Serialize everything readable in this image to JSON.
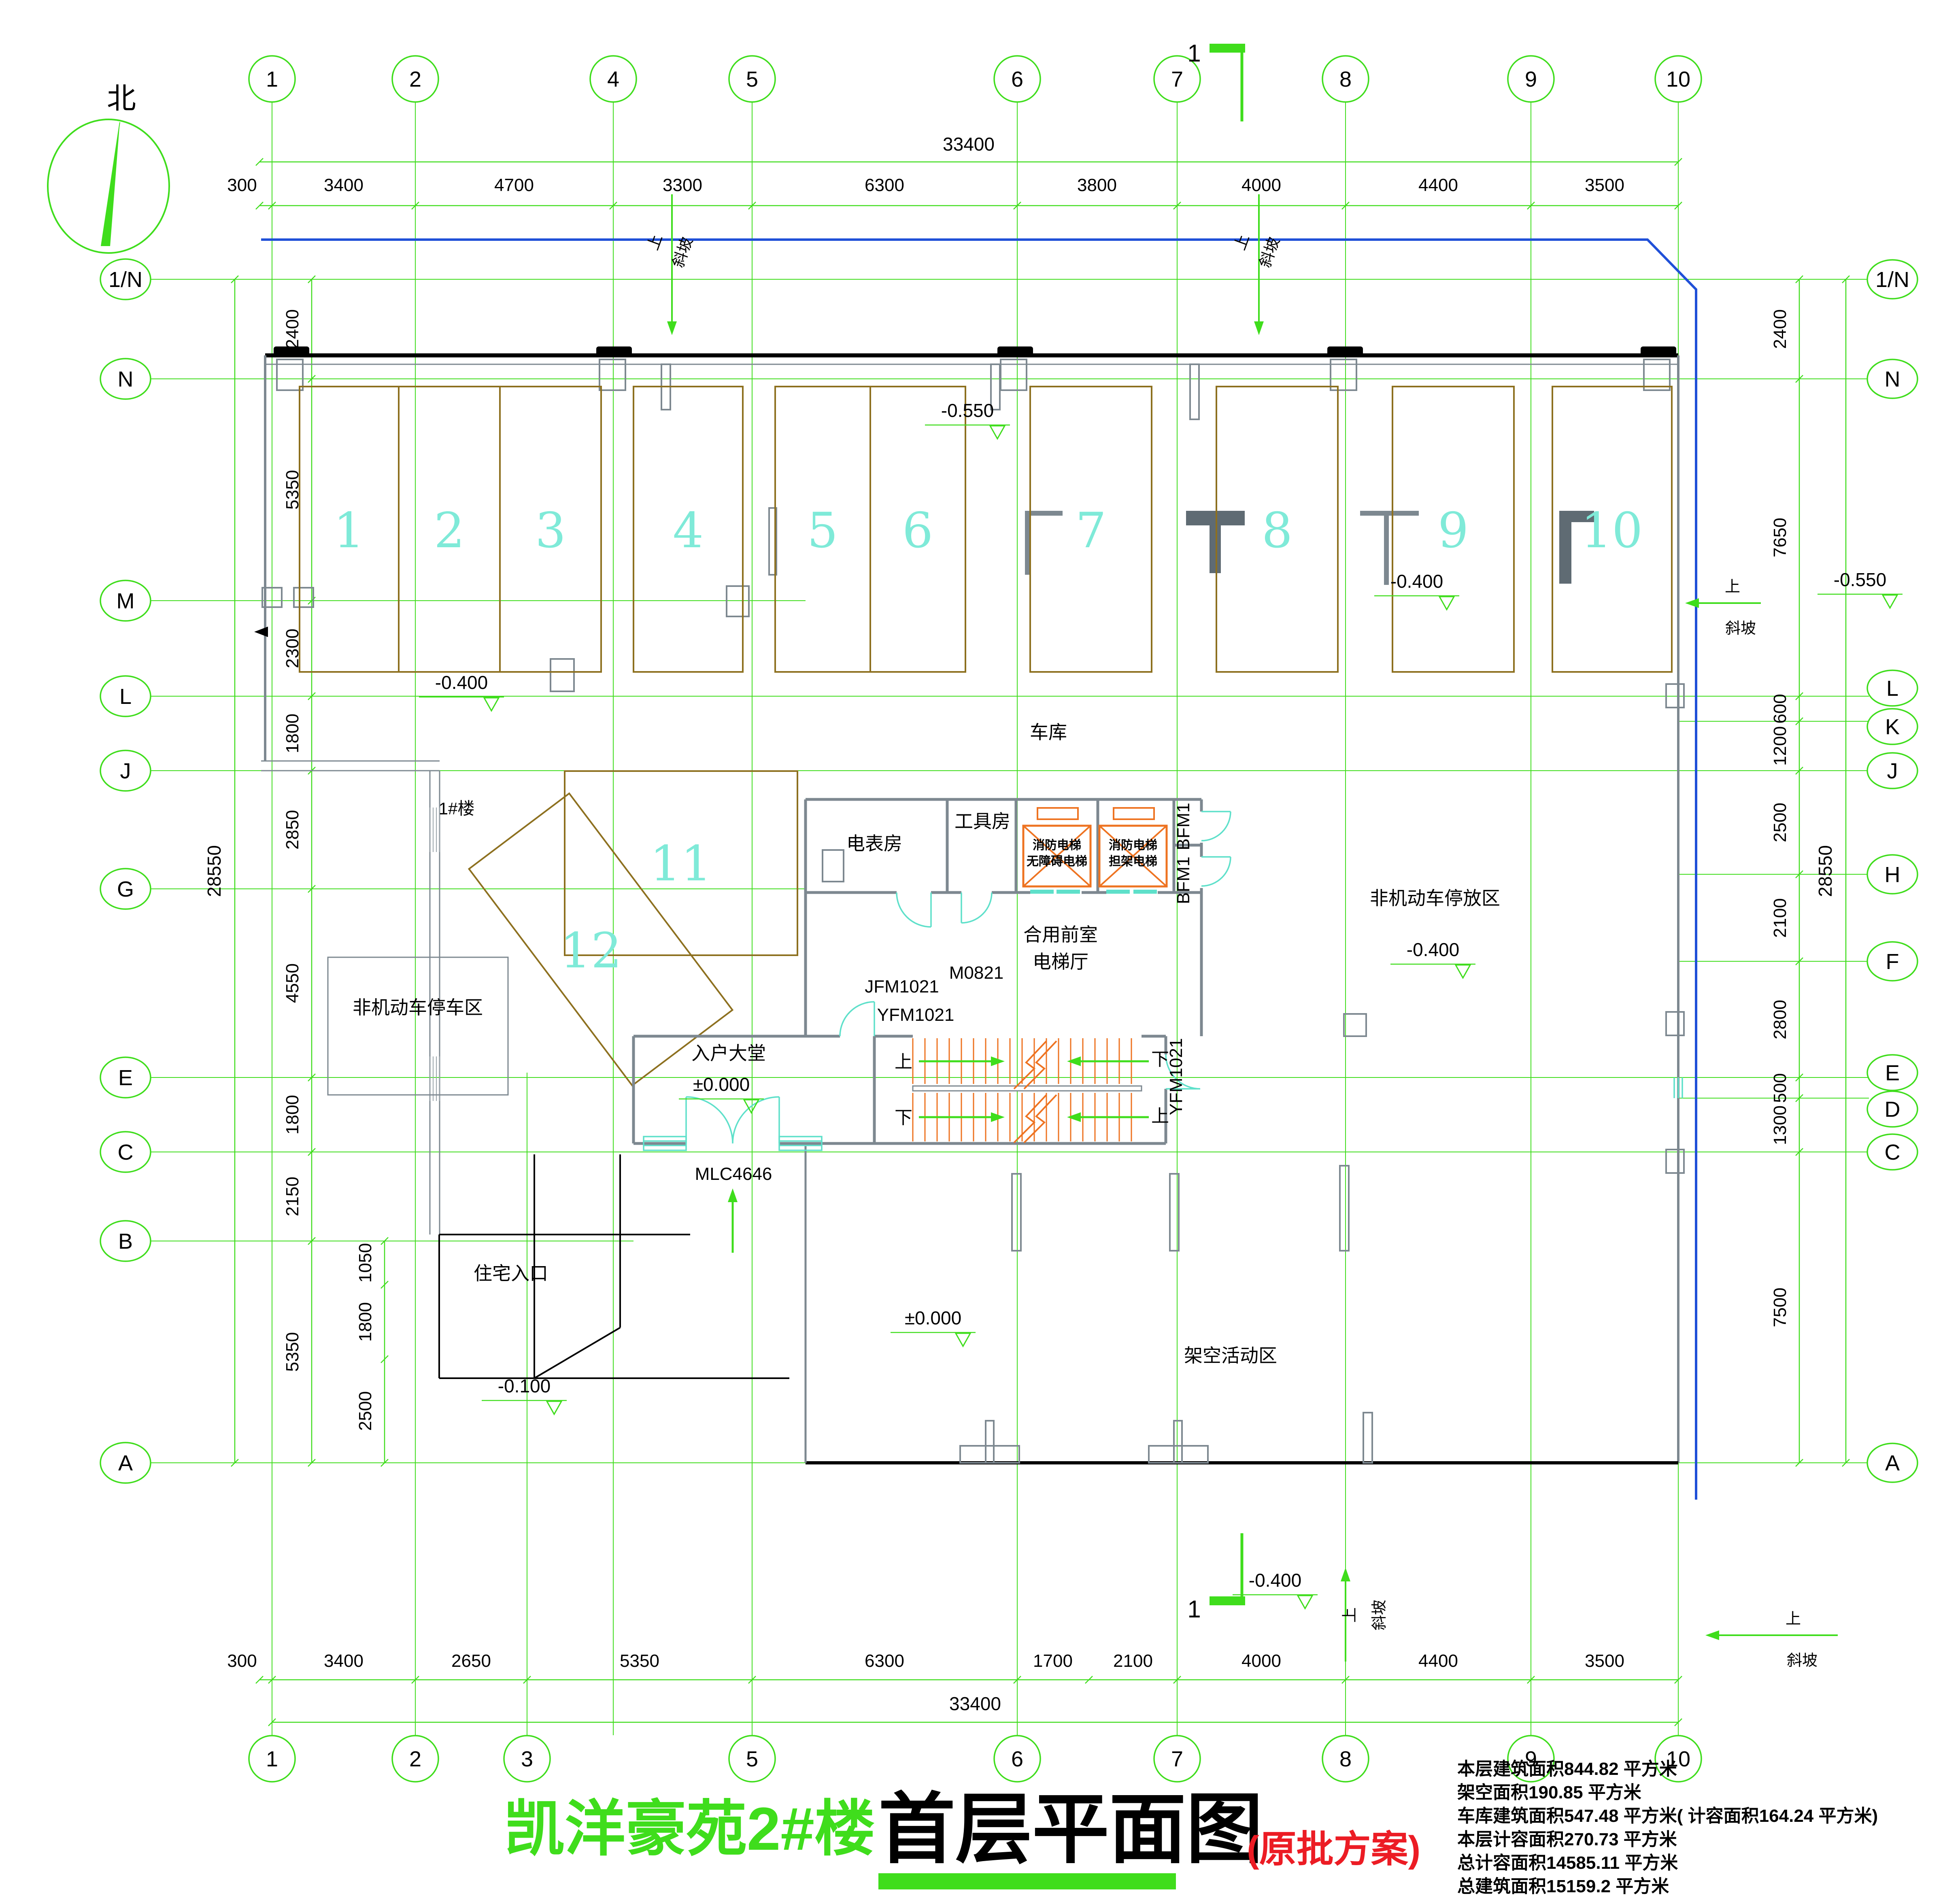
{
  "title": {
    "project": "凯洋豪苑2#楼",
    "name": "首层平面图",
    "scheme": "(原批方案)"
  },
  "north": "北",
  "section_mark": "1",
  "stats": [
    "本层建筑面积844.82      平方米",
    "架空面积190.85      平方米",
    "车库建筑面积547.48      平方米( 计容面积164.24 平方米)",
    "本层计容面积270.73      平方米",
    "总计容面积14585.11      平方米",
    "总建筑面积15159.2      平方米"
  ],
  "grid": {
    "top": {
      "total": "33400",
      "dims": [
        "300",
        "3400",
        "4700",
        "3300",
        "6300",
        "3800",
        "4000",
        "4400",
        "3500"
      ],
      "bubbles": [
        "1",
        "2",
        "4",
        "5",
        "6",
        "7",
        "8",
        "9",
        "10"
      ]
    },
    "bottom": {
      "total": "33400",
      "dims": [
        "300",
        "3400",
        "2650",
        "5350",
        "6300",
        "1700",
        "2100",
        "4000",
        "4400",
        "3500"
      ],
      "bubbles": [
        "1",
        "2",
        "3",
        "5",
        "6",
        "7",
        "8",
        "9",
        "10"
      ]
    },
    "left": {
      "total": "28550",
      "dims": [
        "2400",
        "5350",
        "2300",
        "1800",
        "2850",
        "4550",
        "1800",
        "2150",
        "5350"
      ],
      "sub": [
        "1050",
        "1800",
        "2500"
      ],
      "bub": [
        "1/N",
        "N",
        "M",
        "L",
        "J",
        "G",
        "E",
        "C",
        "B",
        "A"
      ]
    },
    "right": {
      "total": "28550",
      "dims": [
        "2400",
        "7650",
        "600",
        "1200",
        "2500",
        "2100",
        "2800",
        "500",
        "1300",
        "7500"
      ],
      "bub": [
        "1/N",
        "N",
        "L",
        "K",
        "J",
        "H",
        "F",
        "E",
        "D",
        "C",
        "A"
      ]
    }
  },
  "parking": {
    "spaces": [
      "1",
      "2",
      "3",
      "4",
      "5",
      "6",
      "7",
      "8",
      "9",
      "10",
      "11",
      "12"
    ]
  },
  "rooms": {
    "garage": "车库",
    "meter": "电表房",
    "tool": "工具房",
    "front1": "合用前室",
    "front2": "电梯厅",
    "lobby": "入户大堂",
    "nonmotor_left": "非机动车停车区",
    "nonmotor_right": "非机动车停放区",
    "elevated": "架空活动区",
    "entrance": "住宅入口",
    "building1": "1#楼"
  },
  "elevators": {
    "left": [
      "消防电梯",
      "无障碍电梯"
    ],
    "right": [
      "消防电梯",
      "担架电梯"
    ]
  },
  "doors": {
    "jfm": "JFM1021",
    "m": "M0821",
    "yfm": "YFM1021",
    "mlc": "MLC4646",
    "bfm": "BFM1"
  },
  "levels": {
    "n550": "-0.550",
    "n400": "-0.400",
    "n100": "-0.100",
    "zero": "±0.000"
  },
  "slope": {
    "up": "上",
    "ramp": "斜坡"
  },
  "stair": {
    "up": "上",
    "down": "下"
  }
}
